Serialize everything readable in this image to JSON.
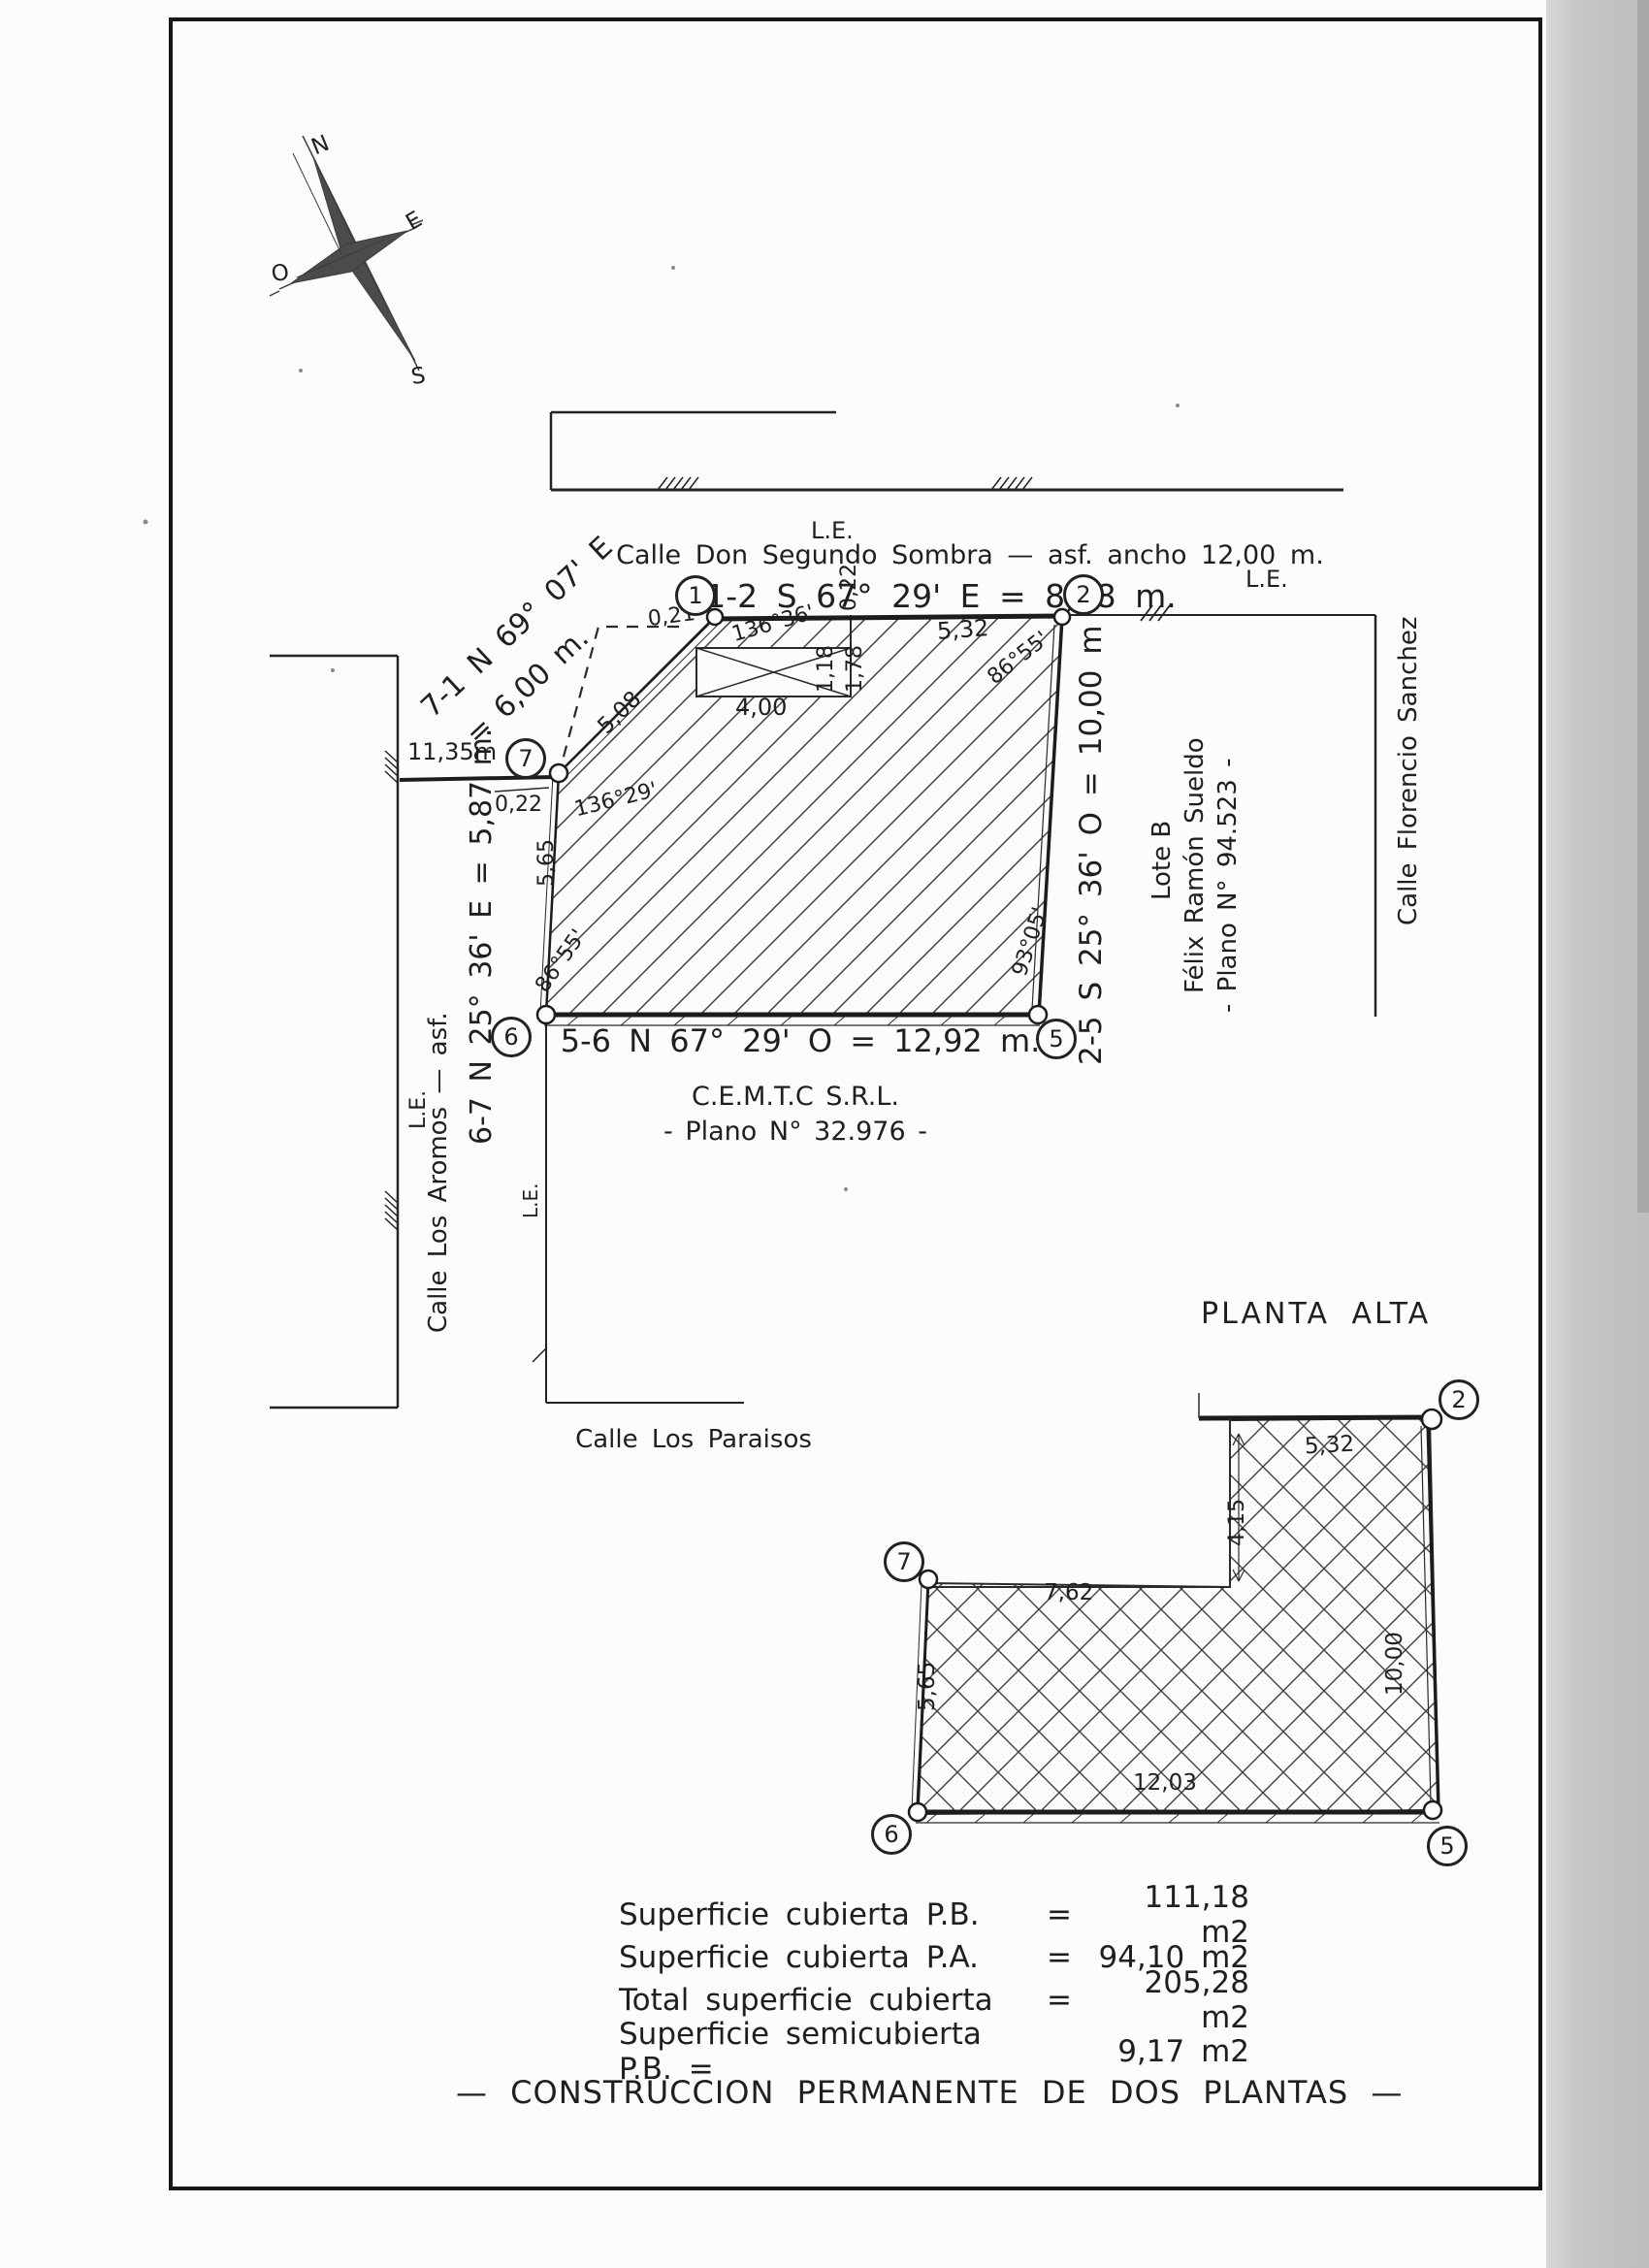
{
  "compass": {
    "n": "N",
    "e": "E",
    "o": "O",
    "s": "S"
  },
  "top_street": {
    "le": "L.E.",
    "name": "Calle Don Segundo Sombra — asf. ancho 12,00 m.",
    "bearing": "1-2 S 67° 29' E = 8,78 m."
  },
  "left_street": {
    "le": "L.E.",
    "name": "Calle Los Aromos — asf.",
    "le_lot": "L.E.",
    "bearing_71_line1": "7-1 N 69° 07' E",
    "bearing_71_line2": "= 6,00 m.",
    "bearing_67": "6-7 N 25° 36' E = 5,87 m.",
    "offset": "11,35m"
  },
  "right_street": {
    "le": "L.E.",
    "name": "Calle Florencio Sanchez",
    "bearing": "2-5 S 25° 36' O = 10,00 m"
  },
  "bottom_street": {
    "name": "Calle Los Paraisos",
    "bearing": "5-6 N 67° 29' O = 12,92 m."
  },
  "neighbor_right": {
    "line1": "Lote B",
    "line2": "Félix Ramón Sueldo",
    "line3": "- Plano N° 94.523 -"
  },
  "neighbor_bottom": {
    "line1": "C.E.M.T.C S.R.L.",
    "line2": "- Plano N° 32.976 -"
  },
  "planta_baja": {
    "vertices": {
      "v1": "1",
      "v2": "2",
      "v5": "5",
      "v6": "6",
      "v7": "7"
    },
    "dims": {
      "d021": "0,21",
      "d022_top": "0,22",
      "d136_36": "136°36'",
      "d532": "5,32",
      "d86_55_v2": "86°55'",
      "d118": "1,18",
      "d178": "1,78",
      "d400": "4,00",
      "d508": "5,08",
      "d136_29": "136°29'",
      "d022_left": "0,22",
      "d565": "5,65",
      "d86_55_v6": "86°55'",
      "d93_05": "93°05'"
    }
  },
  "planta_alta": {
    "title": "PLANTA ALTA",
    "vertices": {
      "v2": "2",
      "v5": "5",
      "v6": "6",
      "v7": "7"
    },
    "dims": {
      "d532": "5,32",
      "d415": "4,15",
      "d762": "7,62",
      "d1000": "10,00",
      "d565": "5,65",
      "d1203": "12,03"
    }
  },
  "areas": {
    "rows": [
      {
        "label": "Superficie cubierta P.B.",
        "eq": "=",
        "value": "111,18 m2"
      },
      {
        "label": "Superficie cubierta P.A.",
        "eq": "=",
        "value": "94,10 m2"
      },
      {
        "label": "Total superficie cubierta",
        "eq": "=",
        "value": "205,28 m2"
      },
      {
        "label": "Superficie semicubierta P.B. =",
        "eq": "",
        "value": "9,17 m2"
      }
    ]
  },
  "footer": "— CONSTRUCCION PERMANENTE DE DOS PLANTAS —"
}
